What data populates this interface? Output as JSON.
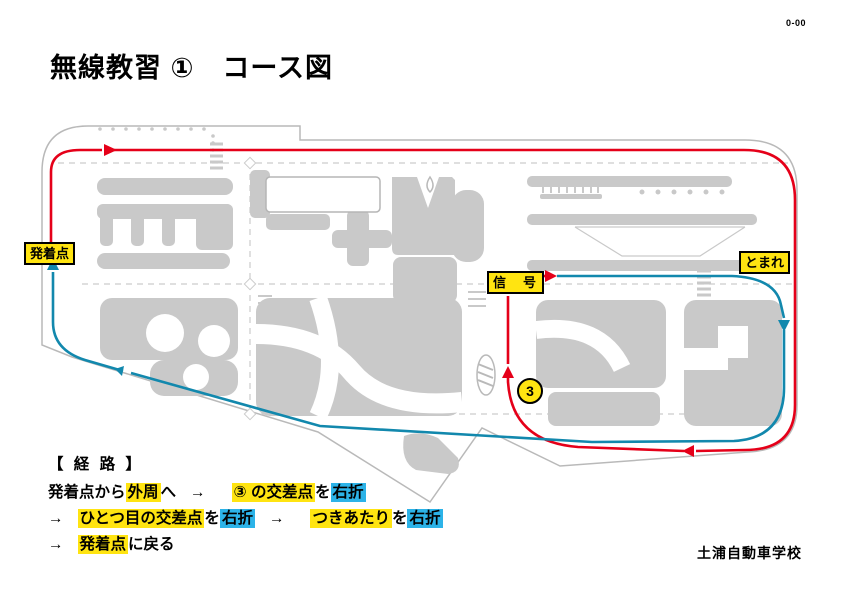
{
  "page": {
    "code": "0-00",
    "title": "無線教習 ①　コース図",
    "school": "土浦自動車学校"
  },
  "map": {
    "labels": {
      "start": "発着点",
      "signal": "信　号",
      "stop": "とまれ",
      "junction3": "3"
    },
    "colors": {
      "route_outbound_red": "#e50019",
      "route_return_blue": "#1288ad",
      "label_yellow": "#ffe411",
      "highlight_cyan": "#2cb3e8",
      "block_gray": "#c9c9c9",
      "boundary_gray": "#b9b9b9"
    }
  },
  "route": {
    "heading": "【 経 路 】",
    "line1": {
      "t1": "発着点から",
      "y1": "外周",
      "t2": "へ",
      "a1": "→",
      "y2": "③ の交差点",
      "t3": "を",
      "c1": "右折"
    },
    "line2": {
      "a1": "→",
      "y1": "ひとつ目の交差点",
      "t1": "を",
      "c1": "右折",
      "a2": "→",
      "y2": "つきあたり",
      "t2": "を",
      "c2": "右折"
    },
    "line3": {
      "a1": "→",
      "y1": "発着点",
      "t1": "に戻る"
    }
  }
}
